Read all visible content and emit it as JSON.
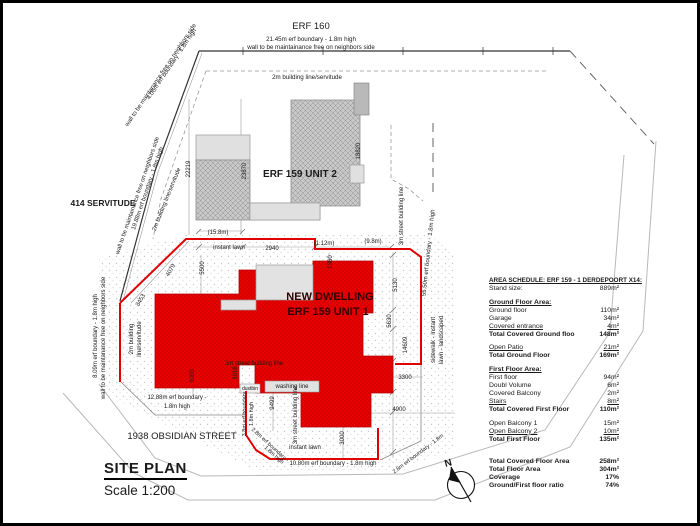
{
  "colors": {
    "dwelling_red": "#e90000",
    "boundary_red": "#e00000",
    "building_gray": "#c8c8c8",
    "line_gray": "#999999"
  },
  "title_block": {
    "title": "SITE PLAN",
    "scale": "Scale 1:200"
  },
  "area_schedule": {
    "title": "AREA SCHEDULE: ERF 159 - 1 DERDEPOORT X14:",
    "rows": [
      {
        "label": "Stand size:",
        "value": "889m²",
        "style": "plain"
      },
      {
        "label": "",
        "value": "",
        "style": "spacer"
      },
      {
        "label": "Ground Floor Area:",
        "value": "",
        "style": "heading"
      },
      {
        "label": "Ground floor",
        "value": "110m²",
        "style": "plain"
      },
      {
        "label": "Garage",
        "value": "34m²",
        "style": "plain"
      },
      {
        "label": "Covered entrance",
        "value": "4m²",
        "style": "sum"
      },
      {
        "label": "Total Covered Ground floo",
        "value": "148m²",
        "style": "total"
      },
      {
        "label": "",
        "value": "",
        "style": "spacer"
      },
      {
        "label": "Open Patio",
        "value": "21m²",
        "style": "sum"
      },
      {
        "label": "Total Ground Floor",
        "value": "169m²",
        "style": "total"
      },
      {
        "label": "",
        "value": "",
        "style": "spacer"
      },
      {
        "label": "First Floor Area:",
        "value": "",
        "style": "heading"
      },
      {
        "label": "First floor",
        "value": "94m²",
        "style": "plain"
      },
      {
        "label": "Doubl Volume",
        "value": "6m²",
        "style": "plain"
      },
      {
        "label": "Covered Balcony",
        "value": "2m²",
        "style": "plain"
      },
      {
        "label": "Stairs",
        "value": "8m²",
        "style": "sum"
      },
      {
        "label": "Total Covered First Floor",
        "value": "110m²",
        "style": "total"
      },
      {
        "label": "",
        "value": "",
        "style": "spacer"
      },
      {
        "label": "Open Balcony 1",
        "value": "15m²",
        "style": "plain"
      },
      {
        "label": "Open Balcony 2",
        "value": "10m²",
        "style": "sum"
      },
      {
        "label": "Total First Floor",
        "value": "135m²",
        "style": "total"
      },
      {
        "label": "",
        "value": "",
        "style": "spacer2"
      },
      {
        "label": "Total Covered Floor Area",
        "value": "258m²",
        "style": "total"
      },
      {
        "label": "Total Floor Area",
        "value": "304m²",
        "style": "total"
      },
      {
        "label": "Coverage",
        "value": "17%",
        "style": "total"
      },
      {
        "label": "Ground/First floor ratio",
        "value": "74%",
        "style": "total"
      }
    ]
  },
  "plan": {
    "labels": [
      {
        "t": "ERF 160",
        "x": 308,
        "y": 26,
        "s": 9.5
      },
      {
        "t": "21.45m erf boundary - 1.8m high",
        "x": 308,
        "y": 38,
        "s": 6.2
      },
      {
        "t": "wall to be maintainance free on neighbors side",
        "x": 308,
        "y": 46,
        "s": 6.2
      },
      {
        "t": "2m building line/servitude",
        "x": 304,
        "y": 76,
        "s": 6.2
      },
      {
        "t": "4.06m erf boundary - 1.8m high",
        "x": 170,
        "y": 62,
        "s": 6,
        "r": -56
      },
      {
        "t": "wall to be maintanance free on neighbors side",
        "x": 159,
        "y": 73,
        "s": 6,
        "r": -56
      },
      {
        "t": "19.88m erf boundary - 1.8m high",
        "x": 146,
        "y": 186,
        "s": 6,
        "r": -71
      },
      {
        "t": "wall to be maintainance free on neighbors side",
        "x": 136,
        "y": 193,
        "s": 6,
        "r": -71
      },
      {
        "t": "414 SERVITUDE",
        "x": 100,
        "y": 203,
        "s": 8.5,
        "w": "bold"
      },
      {
        "t": "2m building line/servitude",
        "x": 165,
        "y": 197,
        "s": 6,
        "r": -68
      },
      {
        "t": "8.09m erf boundary - 1.8m high",
        "x": 94,
        "y": 333,
        "s": 6,
        "r": -90
      },
      {
        "t": "wall to be maintanance free on neighbors side",
        "x": 102,
        "y": 335,
        "s": 6,
        "r": -90
      },
      {
        "t": "2m building",
        "x": 130,
        "y": 336,
        "s": 6,
        "r": -90
      },
      {
        "t": "line/servitude",
        "x": 138,
        "y": 336,
        "s": 6,
        "r": -90
      },
      {
        "t": "22219",
        "x": 187,
        "y": 166,
        "s": 6,
        "r": -90
      },
      {
        "t": "23870",
        "x": 243,
        "y": 168,
        "s": 6,
        "r": -90
      },
      {
        "t": "18820",
        "x": 357,
        "y": 148,
        "s": 6,
        "r": -90
      },
      {
        "t": "ERF 159 UNIT 2",
        "x": 297,
        "y": 174,
        "s": 10,
        "w": "600"
      },
      {
        "t": "(15.8m)",
        "x": 215,
        "y": 231,
        "s": 6
      },
      {
        "t": "instant lawn",
        "x": 226,
        "y": 246,
        "s": 6
      },
      {
        "t": "2940",
        "x": 269,
        "y": 247,
        "s": 6
      },
      {
        "t": "(1.12m)",
        "x": 321,
        "y": 242,
        "s": 6
      },
      {
        "t": "(9.8m)",
        "x": 370,
        "y": 240,
        "s": 6
      },
      {
        "t": "1360",
        "x": 329,
        "y": 259,
        "s": 6,
        "r": -90
      },
      {
        "t": "4079",
        "x": 169,
        "y": 268,
        "s": 6,
        "r": -60
      },
      {
        "t": "5500",
        "x": 201,
        "y": 265,
        "s": 6,
        "r": -90
      },
      {
        "t": "3453",
        "x": 139,
        "y": 298,
        "s": 6,
        "r": -60
      },
      {
        "t": "5130",
        "x": 394,
        "y": 282,
        "s": 6,
        "r": -90
      },
      {
        "t": "5630",
        "x": 388,
        "y": 318,
        "s": 6,
        "r": -90
      },
      {
        "t": "14609",
        "x": 404,
        "y": 342,
        "s": 6,
        "r": -90
      },
      {
        "t": "3300",
        "x": 402,
        "y": 376,
        "s": 6
      },
      {
        "t": "4900",
        "x": 396,
        "y": 408,
        "s": 6
      },
      {
        "t": "3000",
        "x": 191,
        "y": 373,
        "s": 6,
        "r": -90
      },
      {
        "t": "3016",
        "x": 234,
        "y": 370,
        "s": 6,
        "r": -90
      },
      {
        "t": "9499",
        "x": 271,
        "y": 400,
        "s": 6,
        "r": -90
      },
      {
        "t": "3000",
        "x": 341,
        "y": 435,
        "s": 6,
        "r": -90
      },
      {
        "t": "NEW DWELLING",
        "x": 327,
        "y": 297,
        "s": 11,
        "w": "bold",
        "c": "#310000"
      },
      {
        "t": "ERF 159 UNIT 1",
        "x": 325,
        "y": 312,
        "s": 11,
        "w": "bold",
        "c": "#310000"
      },
      {
        "t": "3m street building line",
        "x": 251,
        "y": 362,
        "s": 6
      },
      {
        "t": "dustbin",
        "x": 247,
        "y": 387,
        "s": 5
      },
      {
        "t": "washing line",
        "x": 289,
        "y": 385,
        "s": 6
      },
      {
        "t": "3m street building line",
        "x": 294,
        "y": 412,
        "s": 6,
        "r": -90
      },
      {
        "t": "3m street building line",
        "x": 400,
        "y": 213,
        "s": 6,
        "r": -90
      },
      {
        "t": "55.50m erf boundary - 1.8m high",
        "x": 427,
        "y": 250,
        "s": 6,
        "r": -84
      },
      {
        "t": "sidewalk - instant",
        "x": 432,
        "y": 337,
        "s": 6,
        "r": -90
      },
      {
        "t": "lawn - landscaped",
        "x": 440,
        "y": 337,
        "s": 6,
        "r": -90
      },
      {
        "t": "12.88m erf boundary -",
        "x": 174,
        "y": 396,
        "s": 6
      },
      {
        "t": "1.8m high",
        "x": 174,
        "y": 405,
        "s": 6
      },
      {
        "t": "1938 OBSIDIAN STREET",
        "x": 179,
        "y": 436,
        "s": 9.5
      },
      {
        "t": "3.8m erf boundary",
        "x": 243,
        "y": 411,
        "s": 5.5,
        "r": -90
      },
      {
        "t": "1.8m high",
        "x": 250,
        "y": 411,
        "s": 5.5,
        "r": -90
      },
      {
        "t": "2.8m erf boundary -",
        "x": 266,
        "y": 443,
        "s": 5.5,
        "r": 42
      },
      {
        "t": "1.8m high",
        "x": 270,
        "y": 453,
        "s": 5.5,
        "r": 42
      },
      {
        "t": "10.80m erf boundary - 1.8m high",
        "x": 330,
        "y": 462,
        "s": 6
      },
      {
        "t": "instant lawn",
        "x": 302,
        "y": 446,
        "s": 6
      },
      {
        "t": "2.8m erf boundary - 1.8m",
        "x": 416,
        "y": 452,
        "s": 5.5,
        "r": -37
      },
      {
        "t": "N",
        "x": 446,
        "y": 463,
        "s": 10,
        "w": "bold",
        "r": -15
      }
    ]
  }
}
